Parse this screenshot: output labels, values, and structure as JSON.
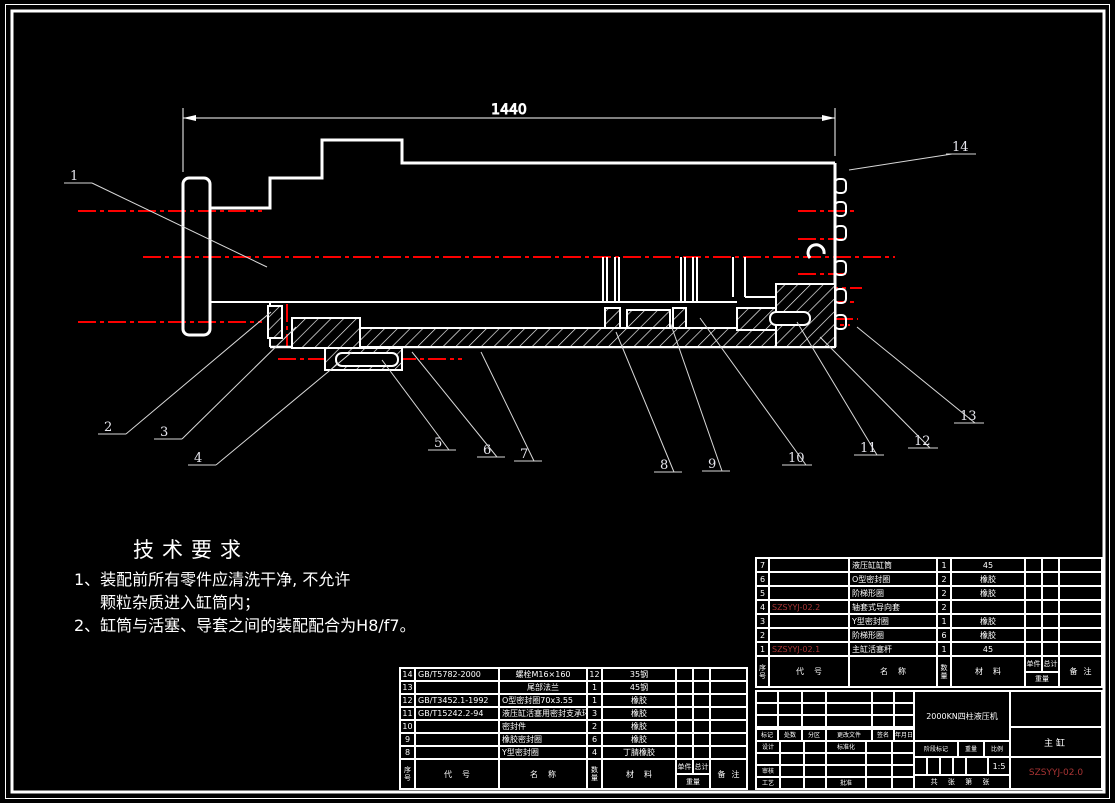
{
  "drawing": {
    "dimension_label": "1440",
    "callouts": [
      "1",
      "2",
      "3",
      "4",
      "5",
      "6",
      "7",
      "8",
      "9",
      "10",
      "11",
      "12",
      "13",
      "14"
    ]
  },
  "tech_requirements": {
    "title": "技术要求",
    "line1": "1、装配前所有零件应清洗干净, 不允许",
    "line2": "颗粒杂质进入缸筒内；",
    "line3": "2、缸筒与活塞、导套之间的装配配合为H8/f7。"
  },
  "bom_headers": {
    "seq": "序号",
    "code": "代号",
    "name": "名称",
    "qty": "数量",
    "material": "材料",
    "unit": "单件",
    "total": "总计",
    "weight": "重量",
    "notes": "备注"
  },
  "bom_mid": {
    "rows": [
      {
        "seq": "14",
        "code": "GB/T5782-2000",
        "name": "螺栓M16×160",
        "qty": "12",
        "material": "35钢"
      },
      {
        "seq": "13",
        "code": "",
        "name": "尾部法兰",
        "qty": "1",
        "material": "45钢"
      },
      {
        "seq": "12",
        "code": "GB/T3452.1-1992",
        "name": "O型密封圈70x3.55",
        "qty": "1",
        "material": "橡胶"
      },
      {
        "seq": "11",
        "code": "GB/T15242.2-94",
        "name": "液压缸活塞用密封支承环",
        "qty": "3",
        "material": "橡胶"
      },
      {
        "seq": "10",
        "code": "",
        "name": "密封件",
        "qty": "2",
        "material": "橡胶"
      },
      {
        "seq": "9",
        "code": "",
        "name": "橡胶密封圈",
        "qty": "6",
        "material": "橡胶"
      },
      {
        "seq": "8",
        "code": "",
        "name": "Y型密封圈",
        "qty": "4",
        "material": "丁腈橡胶"
      }
    ]
  },
  "bom_right": {
    "rows": [
      {
        "seq": "7",
        "code": "",
        "name": "液压缸缸筒",
        "qty": "1",
        "material": "45"
      },
      {
        "seq": "6",
        "code": "",
        "name": "O型密封圈",
        "qty": "2",
        "material": "橡胶"
      },
      {
        "seq": "5",
        "code": "",
        "name": "阶梯形圈",
        "qty": "2",
        "material": "橡胶"
      },
      {
        "seq": "4",
        "code": "SZSYYJ-02.2",
        "name": "轴套式导向套",
        "qty": "2",
        "material": ""
      },
      {
        "seq": "3",
        "code": "",
        "name": "Y型密封圈",
        "qty": "1",
        "material": "橡胶"
      },
      {
        "seq": "2",
        "code": "",
        "name": "阶梯形圈",
        "qty": "6",
        "material": "橡胶"
      },
      {
        "seq": "1",
        "code": "SZSYYJ-02.1",
        "name": "主缸活塞杆",
        "qty": "1",
        "material": "45"
      }
    ]
  },
  "title_block": {
    "product": "2000KN四柱液压机",
    "part_name": "主缸",
    "drawing_no": "SZSYYJ-02.0",
    "stage_label": "阶段标记",
    "weight_label": "重量",
    "scale_label": "比例",
    "scale_value": "1:5",
    "sheet_label": "共  张  第  张",
    "rev_headers": [
      "标记",
      "处数",
      "分区",
      "更改文件",
      "签名",
      "年月日"
    ],
    "roles": {
      "design": "设计",
      "standard": "标准化",
      "review": "审核",
      "process": "工艺",
      "approve": "批准"
    }
  },
  "colors": {
    "line": "#ffffff",
    "centerline": "#fc0000",
    "code_red": "#a83434",
    "background": "#000000"
  }
}
